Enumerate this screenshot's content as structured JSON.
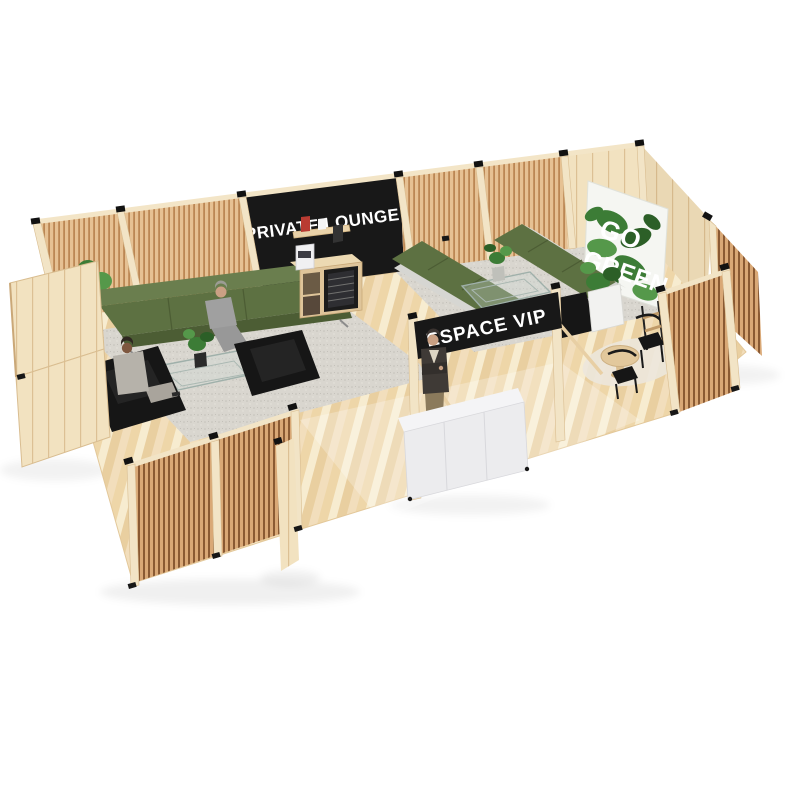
{
  "scene": {
    "description": "Isometric 3D render of a timber-frame exhibition booth with slatted wood walls, a private lounge and a VIP seating area on a light wood floor, white background",
    "background_color": "#ffffff",
    "signs": {
      "private_lounge": {
        "label": "PRIVATE LOUNGE",
        "panel_color": "#181818",
        "text_color": "#ffffff"
      },
      "espace_vip": {
        "label": "ESPACE VIP",
        "panel_color": "#181818",
        "text_color": "#ffffff"
      },
      "go_green": {
        "line1": "GO",
        "line2": "GREEN",
        "poster_color": "#f5f6f2",
        "text_color": "#ffffff",
        "leaf_color": "#3c7c36"
      }
    },
    "palette": {
      "wood_light": "#f2e3c2",
      "wood_slat": "#e6c193",
      "wood_slat_gap": "#bb8754",
      "wood_slat_front": "#d9a876",
      "wood_slat_front_gap": "#8a5a33",
      "floor_wood": "#f3e2bd",
      "floor_stripe": "#ead0a2",
      "sofa_green": "#5d7142",
      "sofa_base_grey": "#d6d6d2",
      "armchair_black": "#161616",
      "rug_grey": "#d9d6cf",
      "cabinet_white": "#ececee",
      "fridge_black": "#1c1c1c",
      "connector_black": "#121212",
      "suit_grey": "#a0a0a0",
      "skin_tone": "#c9a083"
    },
    "objects": [
      "slatted-wood-walls",
      "open-plank-doors",
      "green-three-seat-sofa",
      "two-black-armchairs",
      "glass-coffee-tables",
      "grey-rugs",
      "potted-plants",
      "coffee-bar-with-wine-fridge",
      "two-green-vip-sofas",
      "white-sideboard",
      "round-side-table-with-two-chairs",
      "seated-man",
      "seated-woman",
      "standing-person-arms-crossed"
    ]
  }
}
